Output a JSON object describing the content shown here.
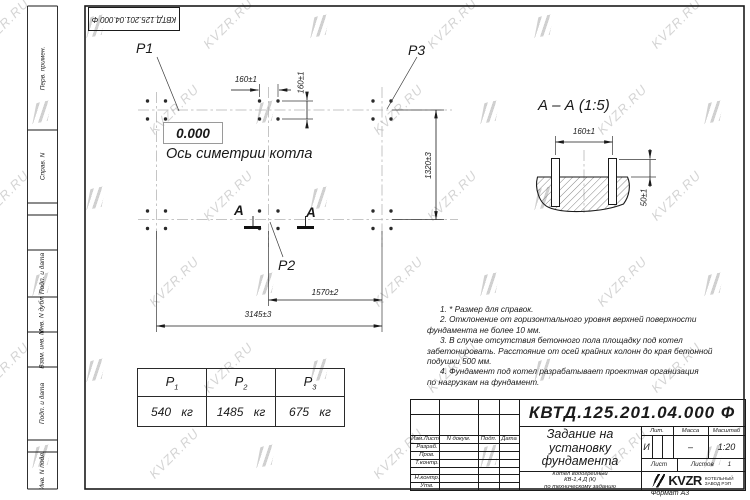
{
  "watermark": {
    "text": "KVZR.RU"
  },
  "stamp_top": {
    "code": "КВТД.125.201.04.000  Ф"
  },
  "left_strip": {
    "items": [
      "Перв. примен.",
      "Справ. N",
      "Подп. и дата",
      "Инв. N дубл.",
      "Взам. инв. N",
      "Подп. и дата",
      "Инв. N подл."
    ]
  },
  "plan": {
    "elevation": "0.000",
    "axis_label": "Ось симетрии котла",
    "labels": {
      "p1": "P1",
      "p2": "P2",
      "p3": "P3"
    },
    "dims": {
      "bolt_spacing_h": "160±1",
      "bolt_spacing_v": "160±1",
      "width": "1320±3",
      "pitch": "1570±2",
      "length": "3145±3"
    },
    "section_letter": "А"
  },
  "section_view": {
    "title": "А – А (1:5)",
    "dims": {
      "bolt_spacing": "160±1",
      "protrusion": "50±1"
    }
  },
  "notes": {
    "lines": [
      {
        "text": "1.  * Размер для справок."
      },
      {
        "text": "2.  Отклонение от горизонтального уровня верхней поверхности"
      },
      {
        "text": "фундамента не более 10 мм."
      },
      {
        "text": "3.  В случае отсутствия бетонного пола площадку под котел"
      },
      {
        "text": "забетонировать. Расстояние от осей крайних колонн до края бетонной"
      },
      {
        "text": "подушки 500 мм."
      },
      {
        "text": "4.  Фундамент под котел разрабатывает проектная организация"
      },
      {
        "text": "по нагрузкам на фундамент."
      }
    ]
  },
  "load_table": {
    "headers": [
      {
        "base": "P",
        "sub": "1"
      },
      {
        "base": "P",
        "sub": "2"
      },
      {
        "base": "P",
        "sub": "3"
      }
    ],
    "values": [
      "540 кг",
      "1485 кг",
      "675 кг"
    ]
  },
  "title_block": {
    "doc_number": "КВТД.125.201.04.000  Ф",
    "doc_title_lines": [
      "Задание на",
      "установку",
      "фундамента"
    ],
    "product_lines": [
      "Котел водогрейный",
      "КВ-1,4  Д  (К)",
      "по техническому заданию"
    ],
    "columns": [
      "Изм.Лист",
      "N докум.",
      "Подп.",
      "Дата"
    ],
    "sign_rows": [
      "Разраб.",
      "Пров.",
      "Т.контр.",
      "",
      "Н.контр.",
      "Утв."
    ],
    "lit_label": "Лит.",
    "mass_label": "Масса",
    "scale_label": "Масштаб",
    "lit_value": "И",
    "mass_value": "–",
    "scale_value": "1:20",
    "sheet_label": "Лист",
    "sheets_label": "Листов",
    "sheets_value": "1",
    "company": {
      "name": "KVZR",
      "caption_lines": [
        "КОТЕЛЬНЫЙ",
        "ЗАВОД РЭП"
      ]
    },
    "format": "Формат А3"
  }
}
